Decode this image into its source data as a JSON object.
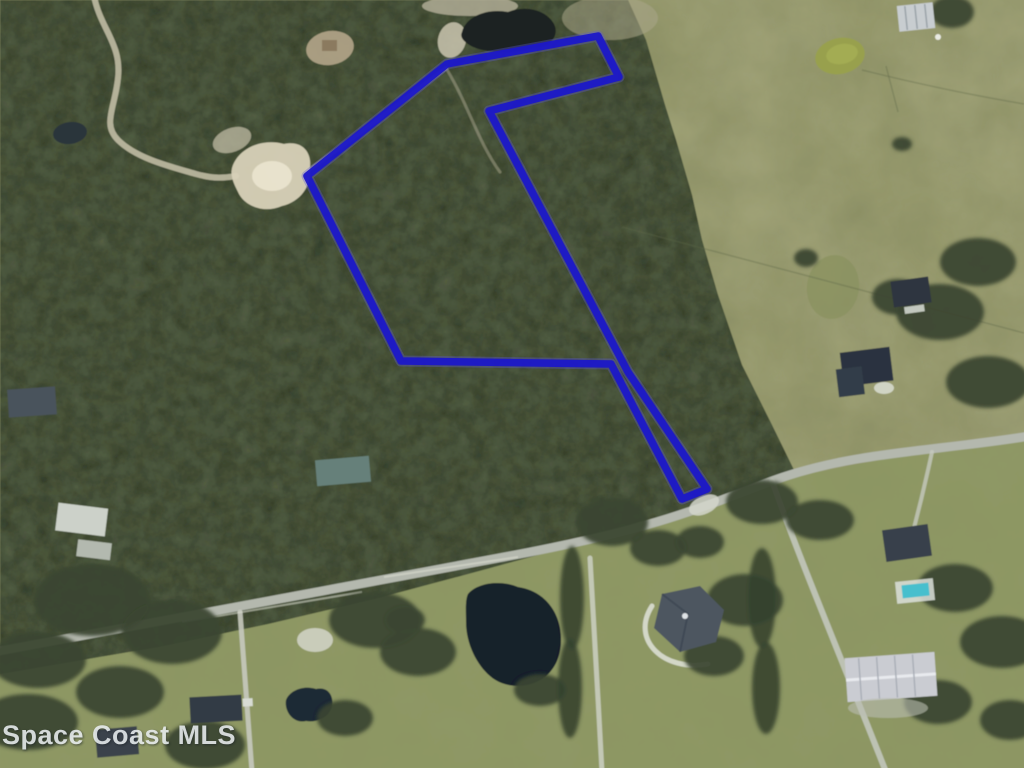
{
  "watermark": {
    "text": "Space Coast MLS"
  },
  "parcel": {
    "outline_color": "#1c18c8",
    "outline_halo_color": "#5b5ad6",
    "outline_width": "7.5",
    "halo_width": "11",
    "points": "447,64 598,36 619,77 489,111 628,372 707,489 682,499 611,364 401,361 307,176"
  },
  "terrain": {
    "pasture_color": "#979a6c",
    "lawn_color": "#8c9763",
    "forest_color": "#49533c",
    "road_color": "#b4b8ae",
    "sand_color": "#d8d1b8",
    "pond_dark_color": "#15202c",
    "pond_top_color": "#1a2422",
    "pond_olive_color": "#98a04e"
  }
}
